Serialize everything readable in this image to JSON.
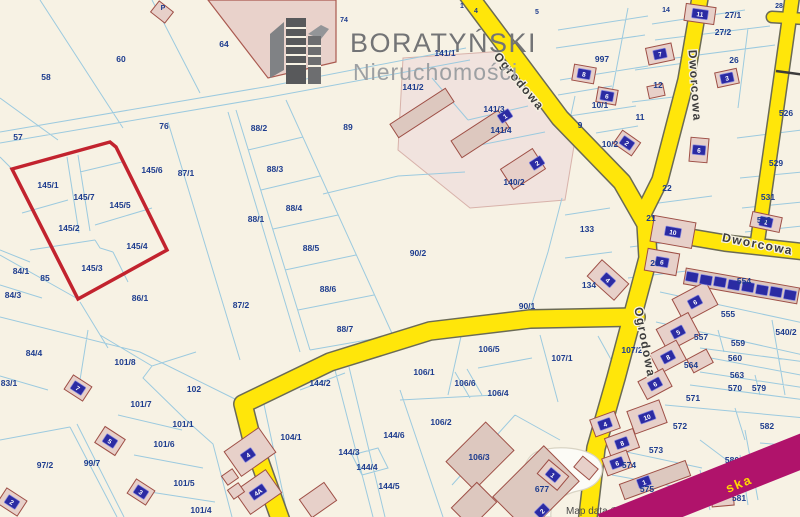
{
  "logo": {
    "title": "BORATYŃSKI",
    "subtitle": "Nieruchomości"
  },
  "attribution": "Map data ©",
  "street_fragment": "ska",
  "colors": {
    "background": "#f7f2e4",
    "parcel_line": "#9ccadf",
    "parcel_label": "#1d3c8e",
    "road_yellow": "#ffe60a",
    "road_label": "#3c3c3c",
    "building_fill": "#e7d0c9",
    "building_stroke": "#9e4f46",
    "address_plate": "#2b2ba3",
    "highlight_parcel": "#c2232e",
    "highlight_street": "#b0136b",
    "highlight_street_text": "#ffd900"
  },
  "road_labels": [
    {
      "t": "Ogrodowa",
      "x": 516,
      "y": 84,
      "r": 50
    },
    {
      "t": "Dworcowa",
      "x": 691,
      "y": 86,
      "r": 86
    },
    {
      "t": "Dworcowa",
      "x": 757,
      "y": 248,
      "r": 11
    },
    {
      "t": "Ogrodowa",
      "x": 641,
      "y": 343,
      "r": 79
    }
  ],
  "parcel_labels": [
    {
      "t": "P",
      "x": 163,
      "y": 10,
      "s": 1
    },
    {
      "t": "1",
      "x": 462,
      "y": 8,
      "s": 1
    },
    {
      "t": "4",
      "x": 476,
      "y": 13,
      "s": 1
    },
    {
      "t": "5",
      "x": 537,
      "y": 14,
      "s": 1
    },
    {
      "t": "74",
      "x": 344,
      "y": 22,
      "s": 1
    },
    {
      "t": "14",
      "x": 666,
      "y": 12,
      "s": 1
    },
    {
      "t": "28",
      "x": 779,
      "y": 8,
      "s": 1
    },
    {
      "t": "27/1",
      "x": 733,
      "y": 18
    },
    {
      "t": "27/2",
      "x": 723,
      "y": 35
    },
    {
      "t": "997",
      "x": 602,
      "y": 62
    },
    {
      "t": "10/1",
      "x": 600,
      "y": 108
    },
    {
      "t": "10/2",
      "x": 610,
      "y": 147
    },
    {
      "t": "11",
      "x": 640,
      "y": 120
    },
    {
      "t": "12",
      "x": 658,
      "y": 88
    },
    {
      "t": "9",
      "x": 580,
      "y": 128
    },
    {
      "t": "26",
      "x": 734,
      "y": 63
    },
    {
      "t": "526",
      "x": 786,
      "y": 116
    },
    {
      "t": "529",
      "x": 776,
      "y": 166
    },
    {
      "t": "531",
      "x": 768,
      "y": 200
    },
    {
      "t": "532",
      "x": 764,
      "y": 223
    },
    {
      "t": "22",
      "x": 667,
      "y": 191
    },
    {
      "t": "21",
      "x": 651,
      "y": 221
    },
    {
      "t": "20",
      "x": 655,
      "y": 266
    },
    {
      "t": "133",
      "x": 587,
      "y": 232
    },
    {
      "t": "134",
      "x": 589,
      "y": 288
    },
    {
      "t": "58",
      "x": 46,
      "y": 80
    },
    {
      "t": "60",
      "x": 121,
      "y": 62
    },
    {
      "t": "64",
      "x": 224,
      "y": 47
    },
    {
      "t": "57",
      "x": 18,
      "y": 140
    },
    {
      "t": "76",
      "x": 164,
      "y": 129
    },
    {
      "t": "88/2",
      "x": 259,
      "y": 131
    },
    {
      "t": "89",
      "x": 348,
      "y": 130
    },
    {
      "t": "88/3",
      "x": 275,
      "y": 172
    },
    {
      "t": "88/4",
      "x": 294,
      "y": 211
    },
    {
      "t": "88/1",
      "x": 256,
      "y": 222
    },
    {
      "t": "88/5",
      "x": 311,
      "y": 251
    },
    {
      "t": "88/6",
      "x": 328,
      "y": 292
    },
    {
      "t": "88/7",
      "x": 345,
      "y": 332
    },
    {
      "t": "141/1",
      "x": 445,
      "y": 56
    },
    {
      "t": "141/2",
      "x": 413,
      "y": 90
    },
    {
      "t": "141/3",
      "x": 494,
      "y": 112
    },
    {
      "t": "141/4",
      "x": 501,
      "y": 133
    },
    {
      "t": "140/2",
      "x": 514,
      "y": 185
    },
    {
      "t": "87/1",
      "x": 186,
      "y": 176
    },
    {
      "t": "87/2",
      "x": 241,
      "y": 308
    },
    {
      "t": "145/6",
      "x": 152,
      "y": 173
    },
    {
      "t": "145/1",
      "x": 48,
      "y": 188
    },
    {
      "t": "145/7",
      "x": 84,
      "y": 200
    },
    {
      "t": "145/5",
      "x": 120,
      "y": 208
    },
    {
      "t": "145/2",
      "x": 69,
      "y": 231
    },
    {
      "t": "145/4",
      "x": 137,
      "y": 249
    },
    {
      "t": "145/3",
      "x": 92,
      "y": 271
    },
    {
      "t": "84/1",
      "x": 21,
      "y": 274
    },
    {
      "t": "85",
      "x": 45,
      "y": 281
    },
    {
      "t": "84/3",
      "x": 13,
      "y": 298
    },
    {
      "t": "86/1",
      "x": 140,
      "y": 301
    },
    {
      "t": "90/2",
      "x": 418,
      "y": 256
    },
    {
      "t": "90/1",
      "x": 527,
      "y": 309
    },
    {
      "t": "84/4",
      "x": 34,
      "y": 356
    },
    {
      "t": "83/1",
      "x": 9,
      "y": 386
    },
    {
      "t": "101/8",
      "x": 125,
      "y": 365
    },
    {
      "t": "102",
      "x": 194,
      "y": 392
    },
    {
      "t": "101/7",
      "x": 141,
      "y": 407
    },
    {
      "t": "101/1",
      "x": 183,
      "y": 427
    },
    {
      "t": "101/6",
      "x": 164,
      "y": 447
    },
    {
      "t": "97/2",
      "x": 45,
      "y": 468
    },
    {
      "t": "99/7",
      "x": 92,
      "y": 466
    },
    {
      "t": "101/5",
      "x": 184,
      "y": 486
    },
    {
      "t": "101/4",
      "x": 201,
      "y": 513
    },
    {
      "t": "106/5",
      "x": 489,
      "y": 352
    },
    {
      "t": "107/2",
      "x": 632,
      "y": 353
    },
    {
      "t": "107/1",
      "x": 562,
      "y": 361
    },
    {
      "t": "106/1",
      "x": 424,
      "y": 375
    },
    {
      "t": "106/6",
      "x": 465,
      "y": 386
    },
    {
      "t": "106/4",
      "x": 498,
      "y": 396
    },
    {
      "t": "106/2",
      "x": 441,
      "y": 425
    },
    {
      "t": "106/3",
      "x": 479,
      "y": 460
    },
    {
      "t": "677",
      "x": 542,
      "y": 492
    },
    {
      "t": "144/2",
      "x": 320,
      "y": 386
    },
    {
      "t": "144/6",
      "x": 394,
      "y": 438
    },
    {
      "t": "144/3",
      "x": 349,
      "y": 455
    },
    {
      "t": "144/4",
      "x": 367,
      "y": 470
    },
    {
      "t": "144/5",
      "x": 389,
      "y": 489
    },
    {
      "t": "104/1",
      "x": 291,
      "y": 440
    },
    {
      "t": "554",
      "x": 744,
      "y": 284
    },
    {
      "t": "555",
      "x": 728,
      "y": 317
    },
    {
      "t": "557",
      "x": 701,
      "y": 340
    },
    {
      "t": "559",
      "x": 738,
      "y": 346
    },
    {
      "t": "560",
      "x": 735,
      "y": 361
    },
    {
      "t": "564",
      "x": 691,
      "y": 368
    },
    {
      "t": "563",
      "x": 737,
      "y": 378
    },
    {
      "t": "540/2",
      "x": 786,
      "y": 335
    },
    {
      "t": "570",
      "x": 735,
      "y": 391
    },
    {
      "t": "579",
      "x": 759,
      "y": 391
    },
    {
      "t": "571",
      "x": 693,
      "y": 401
    },
    {
      "t": "572",
      "x": 680,
      "y": 429
    },
    {
      "t": "573",
      "x": 656,
      "y": 453
    },
    {
      "t": "574",
      "x": 629,
      "y": 468
    },
    {
      "t": "575",
      "x": 647,
      "y": 492
    },
    {
      "t": "576",
      "x": 680,
      "y": 503
    },
    {
      "t": "580",
      "x": 732,
      "y": 463
    },
    {
      "t": "581",
      "x": 739,
      "y": 501
    },
    {
      "t": "582",
      "x": 767,
      "y": 429
    },
    {
      "t": "583",
      "x": 783,
      "y": 453
    }
  ],
  "address_plates": [
    {
      "t": "7",
      "x": 78,
      "y": 388,
      "r": 33
    },
    {
      "t": "5",
      "x": 110,
      "y": 441,
      "r": 33
    },
    {
      "t": "3",
      "x": 141,
      "y": 492,
      "r": 33
    },
    {
      "t": "2",
      "x": 12,
      "y": 502,
      "r": 33
    },
    {
      "t": "1",
      "x": 505,
      "y": 116,
      "r": -33
    },
    {
      "t": "2",
      "x": 537,
      "y": 163,
      "r": -33
    },
    {
      "t": "11",
      "x": 700,
      "y": 14,
      "r": 8
    },
    {
      "t": "7",
      "x": 660,
      "y": 54,
      "r": -12
    },
    {
      "t": "8",
      "x": 584,
      "y": 74,
      "r": 10
    },
    {
      "t": "6",
      "x": 607,
      "y": 96,
      "r": 10
    },
    {
      "t": "3",
      "x": 727,
      "y": 78,
      "r": -12
    },
    {
      "t": "2",
      "x": 627,
      "y": 143,
      "r": 35
    },
    {
      "t": "6",
      "x": 699,
      "y": 150,
      "r": 5
    },
    {
      "t": "10",
      "x": 673,
      "y": 232,
      "r": 10
    },
    {
      "t": "6",
      "x": 662,
      "y": 262,
      "r": 10
    },
    {
      "t": "1",
      "x": 766,
      "y": 222,
      "r": 12
    },
    {
      "t": "4",
      "x": 608,
      "y": 280,
      "r": 42
    },
    {
      "t": "",
      "x": 692,
      "y": 277,
      "r": 10
    },
    {
      "t": "",
      "x": 706,
      "y": 280,
      "r": 10
    },
    {
      "t": "",
      "x": 720,
      "y": 282,
      "r": 10
    },
    {
      "t": "",
      "x": 734,
      "y": 285,
      "r": 10
    },
    {
      "t": "",
      "x": 748,
      "y": 287,
      "r": 10
    },
    {
      "t": "",
      "x": 762,
      "y": 290,
      "r": 10
    },
    {
      "t": "",
      "x": 776,
      "y": 292,
      "r": 10
    },
    {
      "t": "",
      "x": 790,
      "y": 295,
      "r": 10
    },
    {
      "t": "6",
      "x": 695,
      "y": 302,
      "r": -28
    },
    {
      "t": "5",
      "x": 678,
      "y": 332,
      "r": -28
    },
    {
      "t": "8",
      "x": 668,
      "y": 357,
      "r": -28
    },
    {
      "t": "6",
      "x": 655,
      "y": 384,
      "r": -28
    },
    {
      "t": "10",
      "x": 647,
      "y": 417,
      "r": -20
    },
    {
      "t": "4",
      "x": 605,
      "y": 424,
      "r": -20
    },
    {
      "t": "8",
      "x": 622,
      "y": 443,
      "r": -20
    },
    {
      "t": "6",
      "x": 617,
      "y": 463,
      "r": -20
    },
    {
      "t": "1",
      "x": 644,
      "y": 482,
      "r": -20
    },
    {
      "t": "3",
      "x": 676,
      "y": 508,
      "r": -20
    },
    {
      "t": "5",
      "x": 690,
      "y": 505,
      "r": -20
    },
    {
      "t": "7",
      "x": 704,
      "y": 502,
      "r": -20
    },
    {
      "t": "4",
      "x": 248,
      "y": 455,
      "r": -35
    },
    {
      "t": "4A",
      "x": 258,
      "y": 492,
      "r": -35
    },
    {
      "t": "2",
      "x": 542,
      "y": 511,
      "r": -45
    },
    {
      "t": "1",
      "x": 553,
      "y": 475,
      "r": 40
    }
  ]
}
